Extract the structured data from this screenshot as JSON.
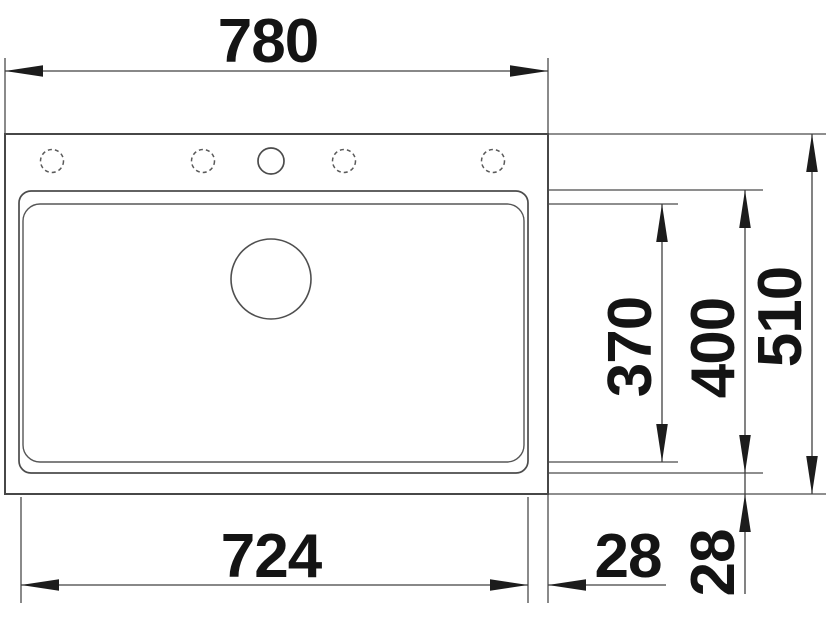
{
  "drawing": {
    "kind": "technical-dimension-drawing",
    "subject": "kitchen sink top view with mounting dimensions",
    "units_implied": "mm",
    "labels": {
      "overall_width": "780",
      "overall_depth": "510",
      "basin_width": "724",
      "basin_outer_depth": "400",
      "basin_inner_depth": "370",
      "edge_offset_right": "28",
      "edge_offset_front": "28"
    },
    "features": {
      "tap_holes_dashed": 4,
      "tap_holes_solid": 1,
      "drain_hole": 1
    },
    "colors": {
      "background": "#ffffff",
      "outline": "#474747",
      "dimension_line": "#404040",
      "text": "#141414"
    }
  }
}
